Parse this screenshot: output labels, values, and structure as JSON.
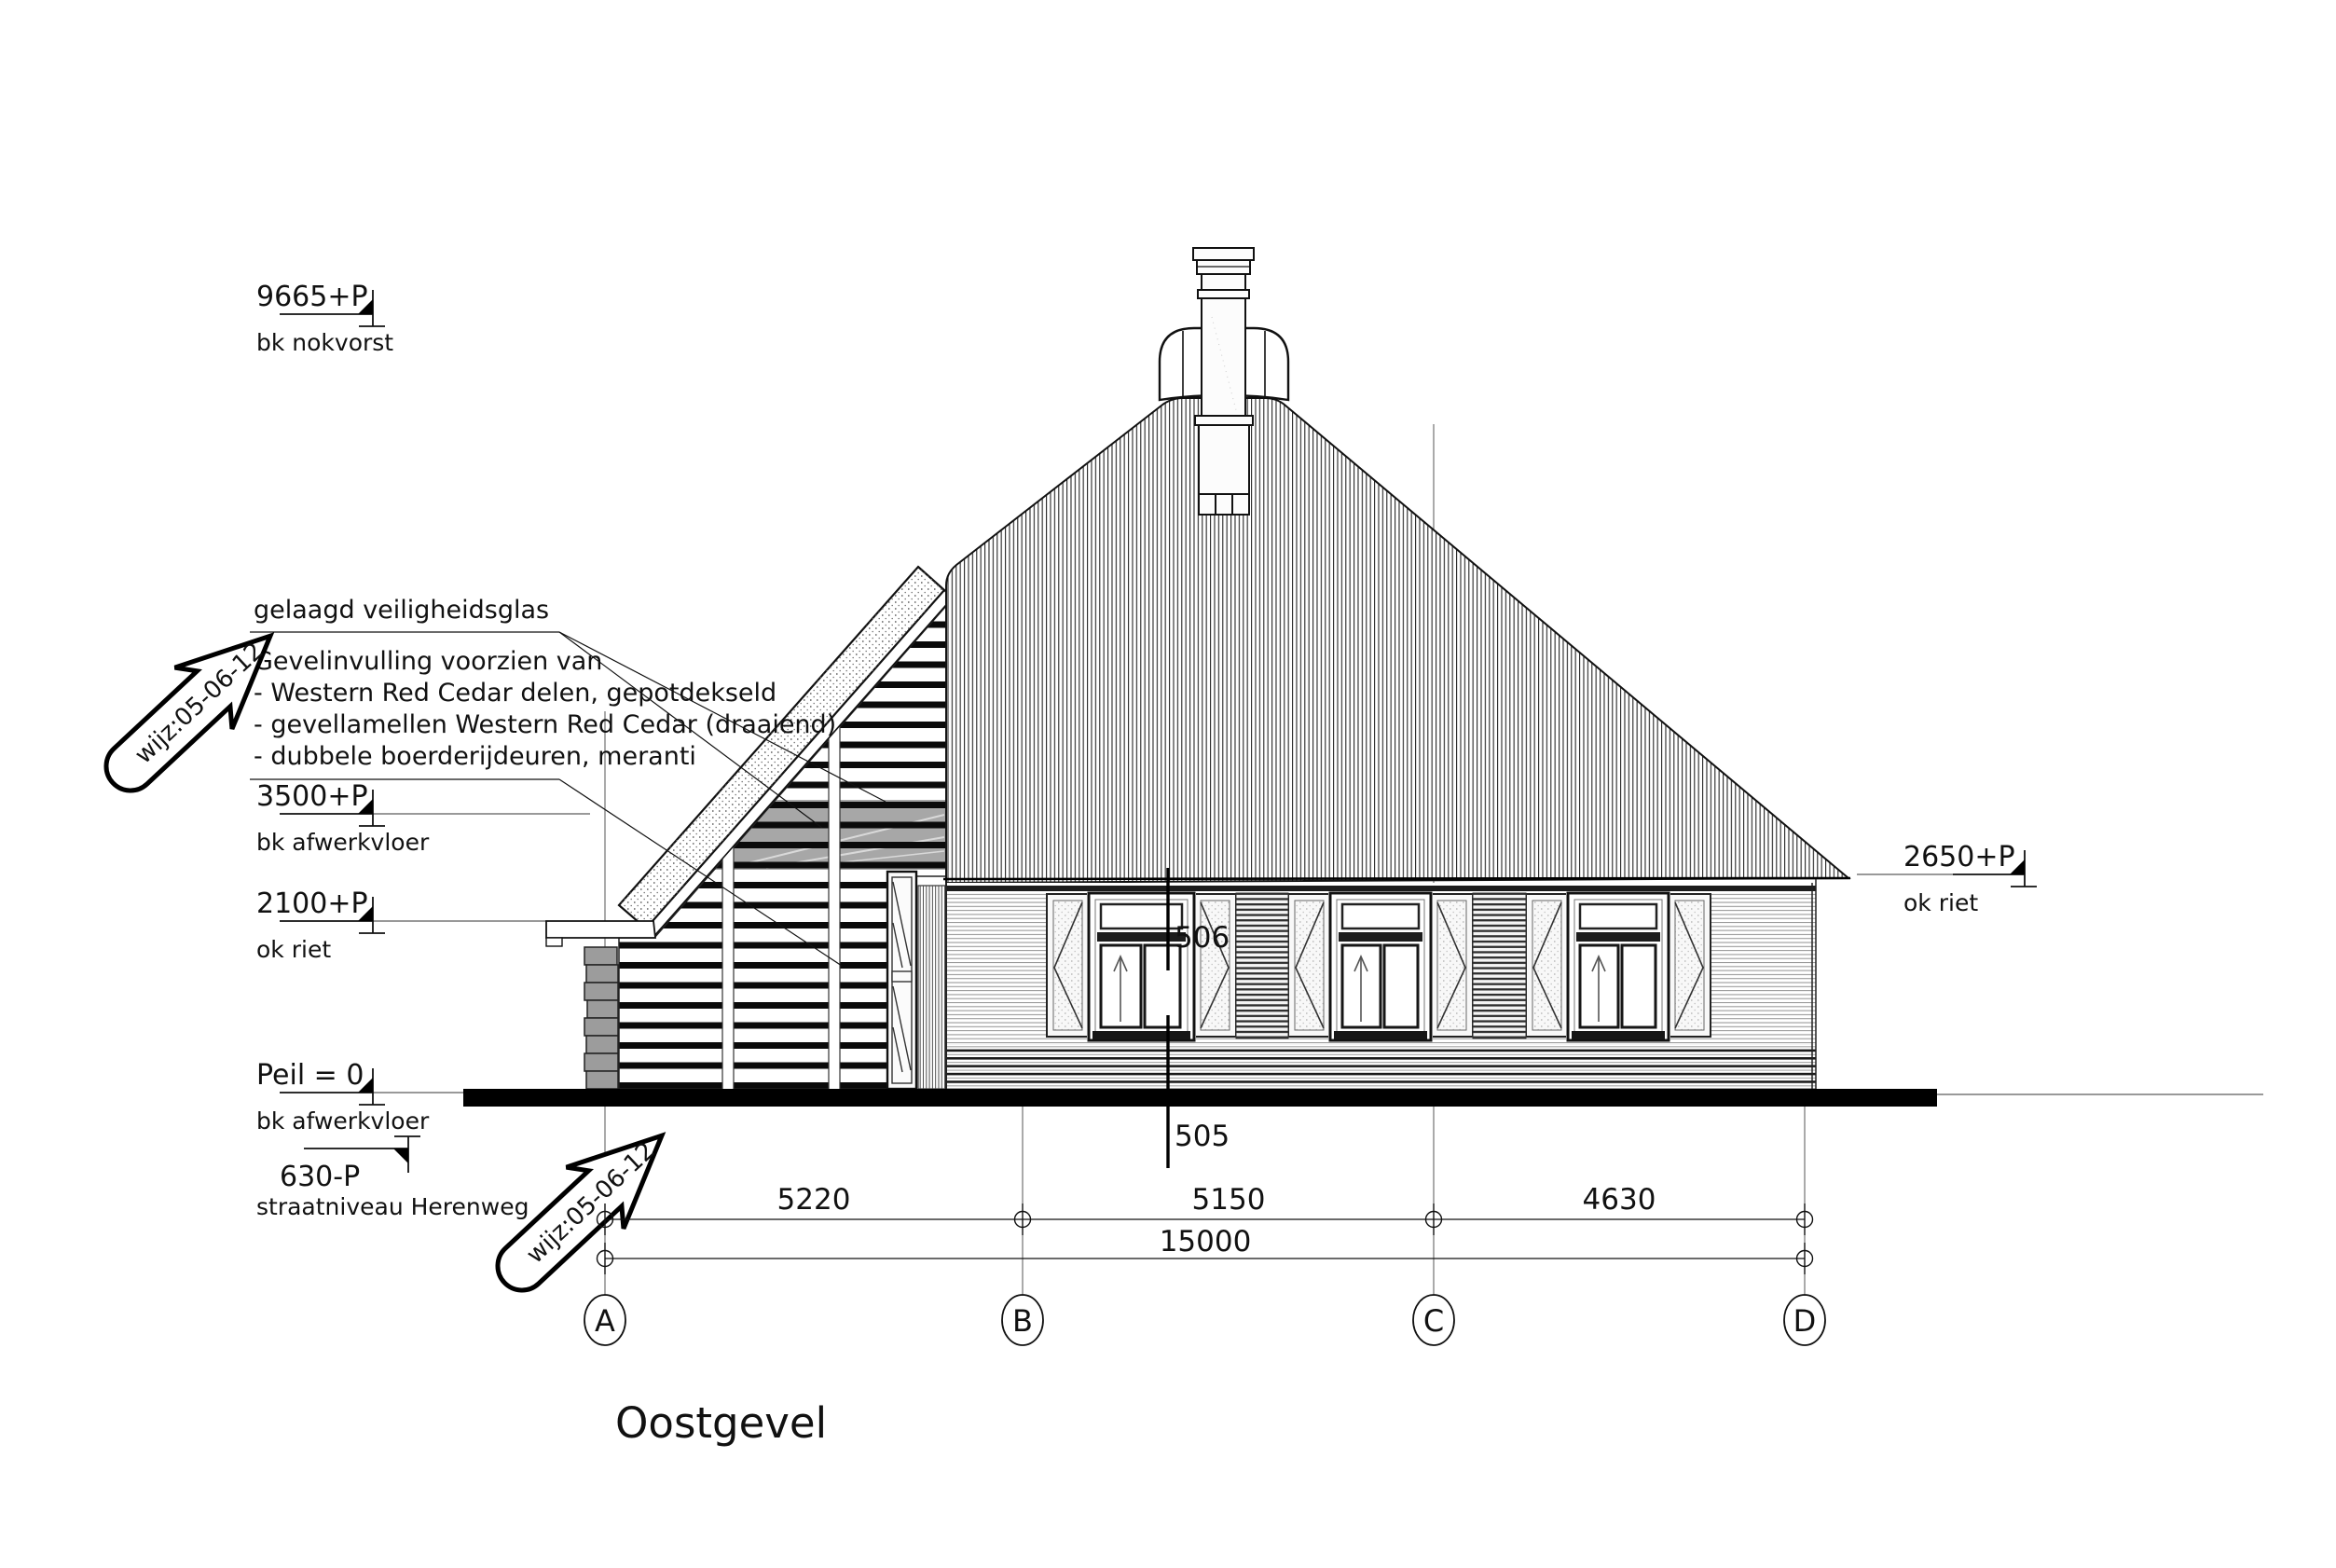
{
  "drawing": {
    "title": "Oostgevel",
    "revision_note": "wijz:05-06-12",
    "levels": [
      {
        "value": "9665+P",
        "label": "bk nokvorst"
      },
      {
        "value": "3500+P",
        "label": "bk afwerkvloer"
      },
      {
        "value": "2100+P",
        "label": "ok riet"
      },
      {
        "value": "Peil = 0",
        "label": "bk afwerkvloer"
      },
      {
        "value": "630-P",
        "label": "straatniveau Herenweg"
      },
      {
        "value": "2650+P",
        "label": "ok riet"
      }
    ],
    "annotations": {
      "glass": "gelaagd veiligheidsglas",
      "facade_title": "Gevelinvulling voorzien van",
      "facade_items": [
        "- Western Red Cedar delen, gepotdekseld",
        "- gevellamellen Western Red Cedar (draaiend)",
        "- dubbele boerderijdeuren, meranti"
      ]
    },
    "sections": {
      "upper": "506",
      "lower": "505"
    },
    "dimensions": {
      "d1": "5220",
      "d2": "5150",
      "d3": "4630",
      "total": "15000"
    },
    "grid": {
      "a": "A",
      "b": "B",
      "c": "C",
      "d": "D"
    }
  }
}
